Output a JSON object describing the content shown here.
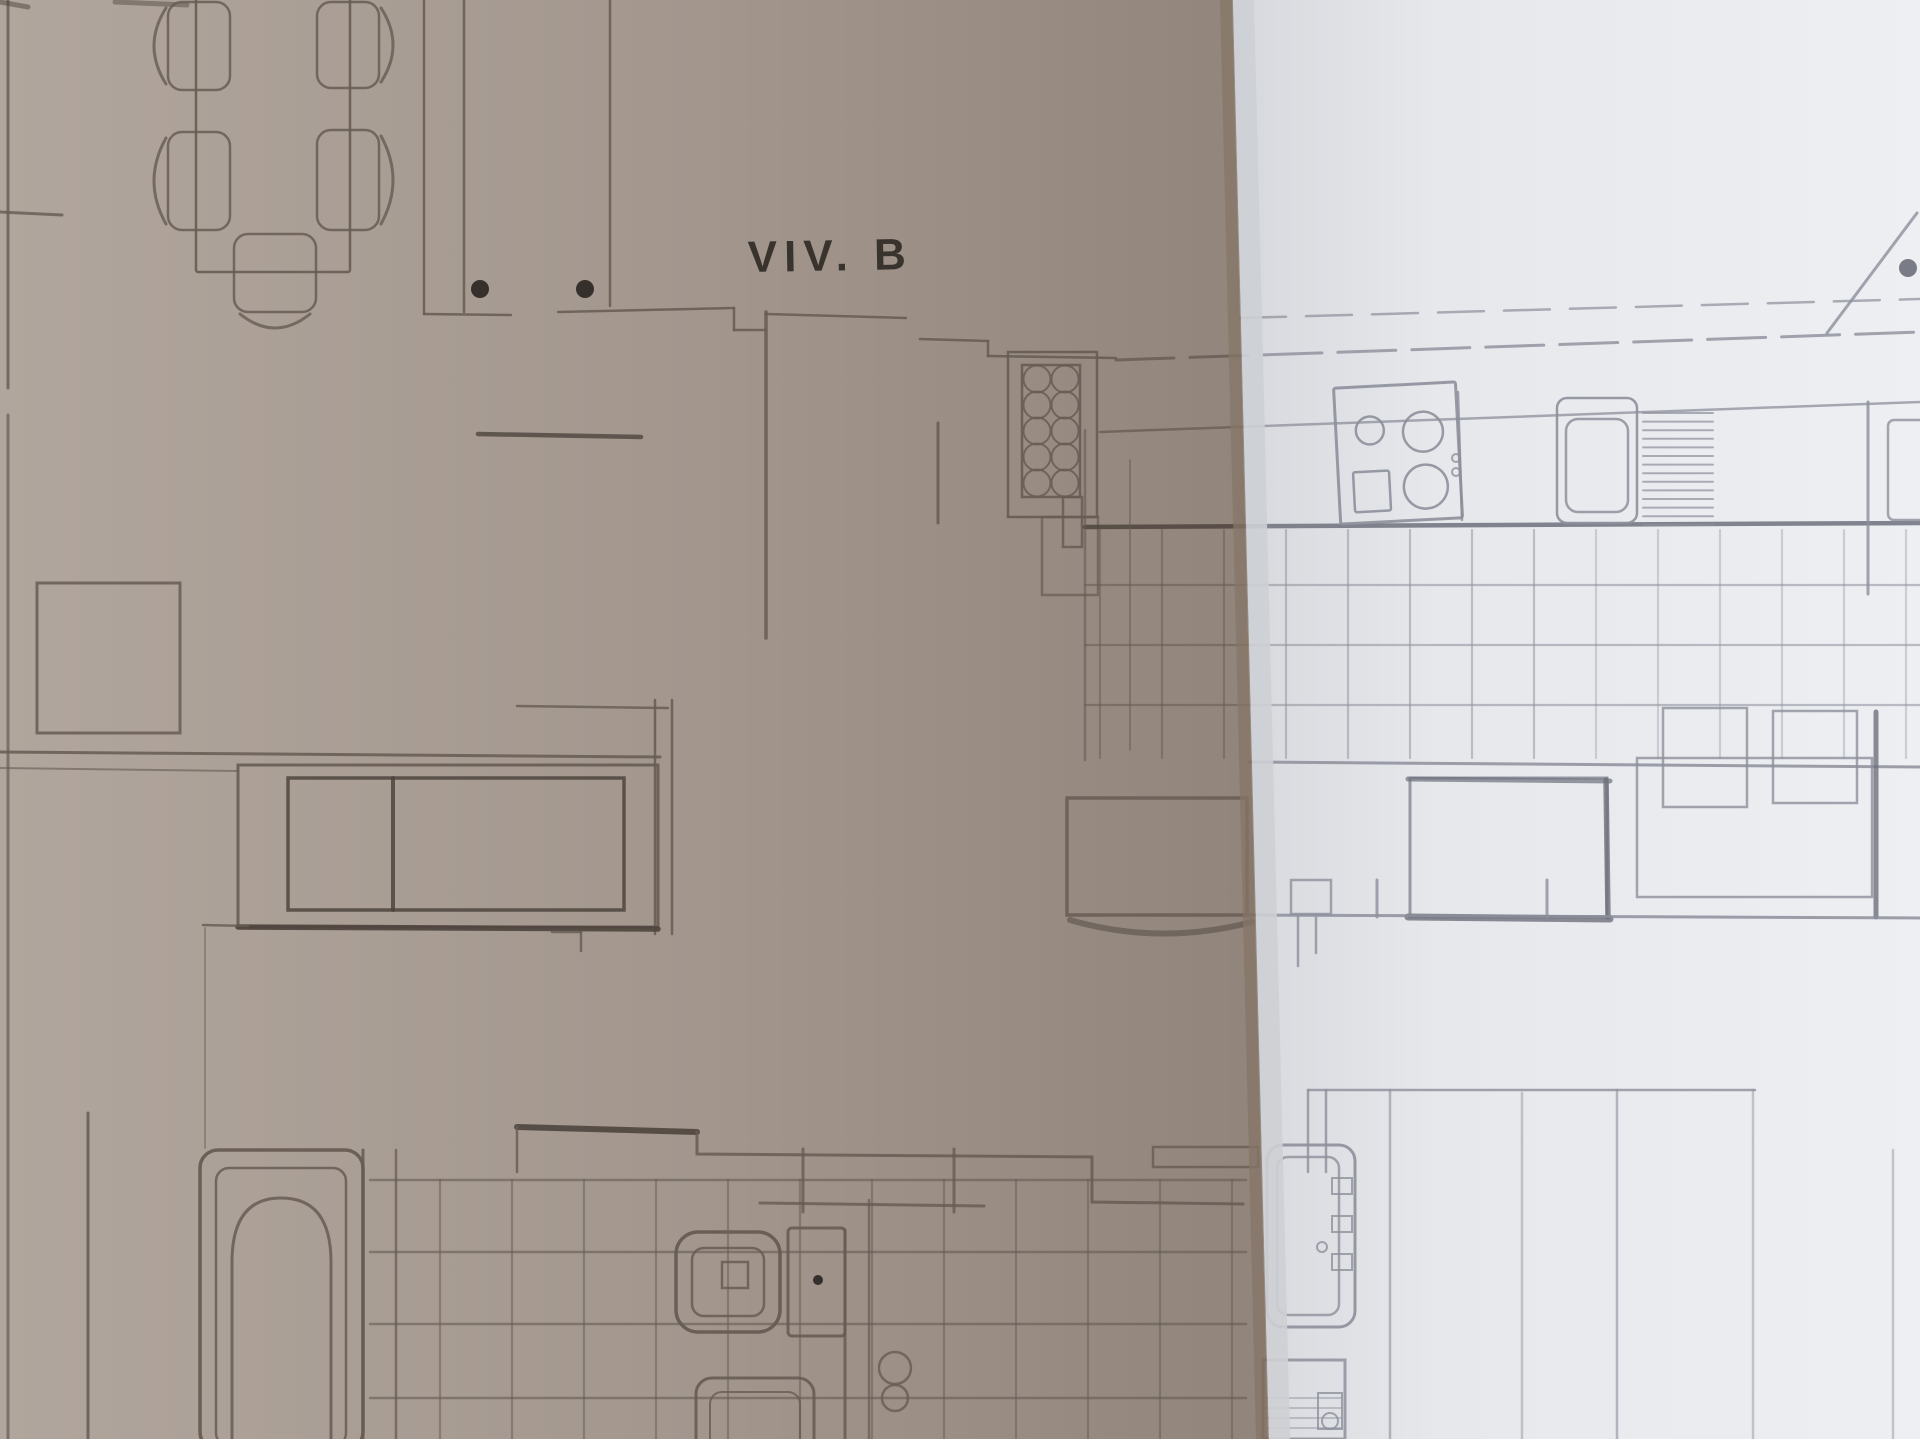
{
  "meta": {
    "kind": "photograph-of-architectural-floor-plan",
    "description": "Pencil-drawn apartment floor plan on folded paper; left half of sheet in shadow, right half brightly lit"
  },
  "labels": {
    "unit_label": "VIV. B"
  },
  "palette": {
    "paper_shadow_left": "#b1a69d",
    "paper_shadow_mid": "#a2968d",
    "paper_shadow_fold": "#90847b",
    "fold_edge": "#857567",
    "paper_bright_fold": "#d2d4d9",
    "paper_bright_mid": "#e6e8ec",
    "paper_bright_right": "#edeff3",
    "pencil_shadow": "#675c53",
    "pencil_shadow_heavy": "#4e453e",
    "pencil_bright": "#8d909b",
    "pencil_bright_heavy": "#6f727d",
    "ink_dot": "#2b2724",
    "label_text": "#39332e"
  },
  "plan": {
    "rooms": [
      "living-dining-room",
      "kitchen",
      "bathroom-1",
      "bathroom-2",
      "hallway"
    ],
    "fixtures": [
      {
        "name": "dining-table",
        "chairs": 5
      },
      {
        "name": "sideboard-sofa"
      },
      {
        "name": "storage-cabinet"
      },
      {
        "name": "pantry-rack",
        "circles": 10
      },
      {
        "name": "cooktop",
        "burners": 3
      },
      {
        "name": "kitchen-sink"
      },
      {
        "name": "drainboard"
      },
      {
        "name": "kitchen-table"
      },
      {
        "name": "kitchen-chairs",
        "count": 2
      },
      {
        "name": "bathtub-1"
      },
      {
        "name": "bathtub-2"
      },
      {
        "name": "toilet-with-cistern"
      },
      {
        "name": "bidet"
      },
      {
        "name": "washbasin-unit"
      },
      {
        "name": "door-hinge-dots",
        "count": 2
      },
      {
        "name": "door-swing-diagonal"
      }
    ],
    "floor_finish": "square-tiles-in-kitchen-and-bathrooms"
  }
}
